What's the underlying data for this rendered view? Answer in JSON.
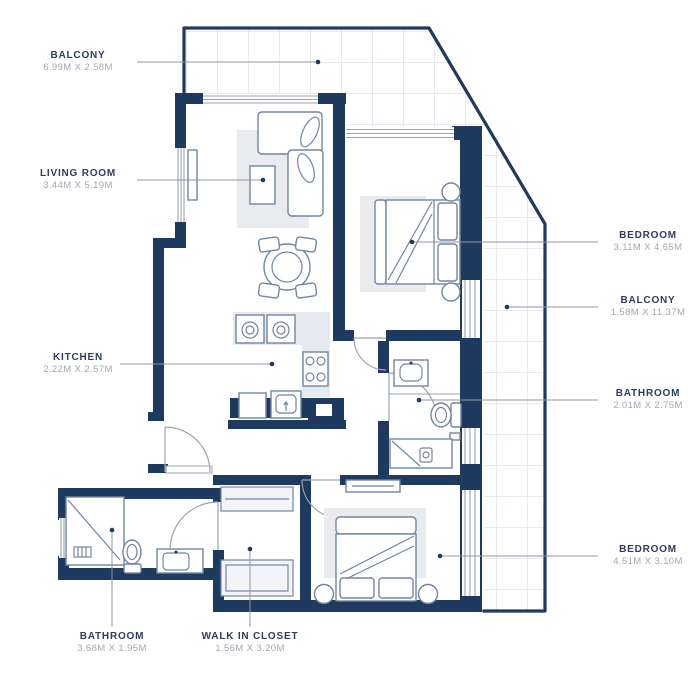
{
  "plan": {
    "title": "Apartment floor plan",
    "labels": {
      "balcony_top": {
        "name": "BALCONY",
        "dims": "6.99M X 2.58M"
      },
      "living_room": {
        "name": "LIVING ROOM",
        "dims": "3.44M X 5.19M"
      },
      "kitchen": {
        "name": "KITCHEN",
        "dims": "2.22M X 2.57M"
      },
      "bedroom_top": {
        "name": "BEDROOM",
        "dims": "3.11M X 4.65M"
      },
      "balcony_right": {
        "name": "BALCONY",
        "dims": "1.58M X 11.37M"
      },
      "bathroom_right": {
        "name": "BATHROOM",
        "dims": "2.01M X 2.75M"
      },
      "bedroom_bottom": {
        "name": "BEDROOM",
        "dims": "4.51M X 3.10M"
      },
      "bathroom_bottom": {
        "name": "BATHROOM",
        "dims": "3.68M X 1.95M"
      },
      "walk_in_closet": {
        "name": "WALK IN CLOSET",
        "dims": "1.56M X 3.20M"
      }
    },
    "colors": {
      "wall": "#1e3a5f",
      "label": "#2e3c63",
      "dims": "#a2a8b3",
      "leader": "#9097a1",
      "grid": "#ccd4e2",
      "winline": "#9aa3b0",
      "furniture": "#7285a3",
      "rug": "#e9ebef",
      "counter": "#e6e9ef"
    }
  }
}
